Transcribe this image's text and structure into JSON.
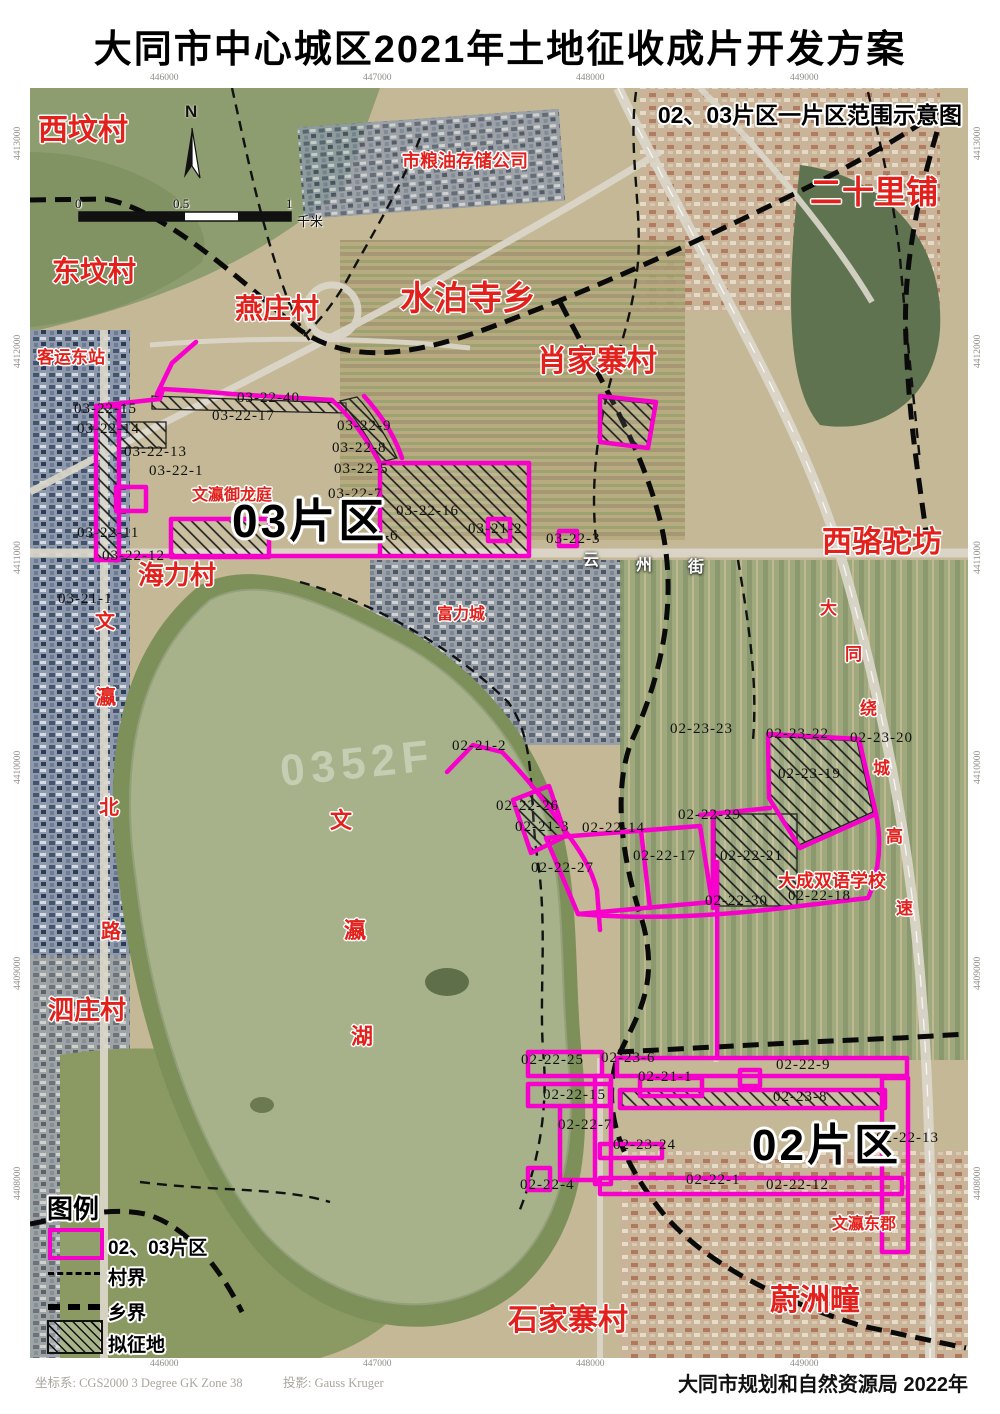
{
  "title": "大同市中心城区2021年土地征收成片开发方案",
  "inset_title": "02、03片区一片区范围示意图",
  "north_label": "N",
  "scale_bar": {
    "ticks": [
      "0",
      "0.5",
      "1"
    ],
    "unit": "千米"
  },
  "legend": {
    "title": "图例",
    "items": [
      {
        "symbol": "magenta-rect",
        "label": "02、03片区"
      },
      {
        "symbol": "thin-dashed-line",
        "label": "村界"
      },
      {
        "symbol": "thick-dashed-line",
        "label": "乡界"
      },
      {
        "symbol": "hatched-rect",
        "label": "拟征地"
      }
    ]
  },
  "footer": {
    "crs_label": "坐标系: CGS2000 3 Degree GK Zone 38",
    "projection_label": "投影: Gauss Kruger",
    "agency": "大同市规划和自然资源局 2022年"
  },
  "colors": {
    "parcel_boundary": "#f800cb",
    "place_label": "#e2211c",
    "district_label": "#000000",
    "road_label": "#ffffff",
    "hatch": "#1a1a1a"
  },
  "grid_coordinates": {
    "top": [
      "446000",
      "447000",
      "448000",
      "449000"
    ],
    "bottom": [
      "446000",
      "447000",
      "448000",
      "449000"
    ],
    "left": [
      "4413000",
      "4412000",
      "4411000",
      "4410000",
      "4409000",
      "4408000"
    ],
    "right": [
      "4413000",
      "4412000",
      "4411000",
      "4410000",
      "4409000",
      "4408000"
    ]
  },
  "map": {
    "area_labels": [
      {
        "t": "03片区",
        "x": 232,
        "y": 498,
        "fs": 46
      },
      {
        "t": "02片区",
        "x": 752,
        "y": 1124,
        "fs": 44
      }
    ],
    "place_labels": [
      {
        "t": "西坟村",
        "x": 38,
        "y": 116,
        "fs": 30
      },
      {
        "t": "东坟村",
        "x": 52,
        "y": 258,
        "fs": 28
      },
      {
        "t": "燕庄村",
        "x": 235,
        "y": 295,
        "fs": 28
      },
      {
        "t": "水泊寺乡",
        "x": 400,
        "y": 282,
        "fs": 34
      },
      {
        "t": "肖家寨村",
        "x": 537,
        "y": 347,
        "fs": 30
      },
      {
        "t": "市粮油存储公司",
        "x": 402,
        "y": 152,
        "fs": 18
      },
      {
        "t": "二十里铺",
        "x": 810,
        "y": 176,
        "fs": 32
      },
      {
        "t": "客运东站",
        "x": 37,
        "y": 349,
        "fs": 17
      },
      {
        "t": "西骆驼坊",
        "x": 822,
        "y": 528,
        "fs": 30
      },
      {
        "t": "海力村",
        "x": 138,
        "y": 562,
        "fs": 26
      },
      {
        "t": "文瀛御龙庭",
        "x": 192,
        "y": 488,
        "fs": 16
      },
      {
        "t": "富力城",
        "x": 437,
        "y": 607,
        "fs": 16
      },
      {
        "t": "大成双语学校",
        "x": 778,
        "y": 872,
        "fs": 18
      },
      {
        "t": "泗庄村",
        "x": 48,
        "y": 997,
        "fs": 26
      },
      {
        "t": "石家寨村",
        "x": 508,
        "y": 1306,
        "fs": 30
      },
      {
        "t": "蔚洲疃",
        "x": 770,
        "y": 1286,
        "fs": 30
      },
      {
        "t": "文瀛东郡",
        "x": 832,
        "y": 1217,
        "fs": 16
      },
      {
        "t": "文",
        "x": 95,
        "y": 612,
        "fs": 20
      },
      {
        "t": "瀛",
        "x": 96,
        "y": 688,
        "fs": 20
      },
      {
        "t": "北",
        "x": 99,
        "y": 798,
        "fs": 20
      },
      {
        "t": "路",
        "x": 101,
        "y": 922,
        "fs": 20
      },
      {
        "t": "文",
        "x": 330,
        "y": 810,
        "fs": 22
      },
      {
        "t": "瀛",
        "x": 344,
        "y": 920,
        "fs": 22
      },
      {
        "t": "湖",
        "x": 351,
        "y": 1026,
        "fs": 22
      },
      {
        "t": "大",
        "x": 820,
        "y": 600,
        "fs": 17
      },
      {
        "t": "同",
        "x": 845,
        "y": 646,
        "fs": 17
      },
      {
        "t": "绕",
        "x": 860,
        "y": 700,
        "fs": 17
      },
      {
        "t": "城",
        "x": 873,
        "y": 760,
        "fs": 17
      },
      {
        "t": "高",
        "x": 886,
        "y": 828,
        "fs": 17
      },
      {
        "t": "速",
        "x": 896,
        "y": 900,
        "fs": 17
      }
    ],
    "road_labels_white": [
      {
        "t": "云",
        "x": 583,
        "y": 553,
        "fs": 16
      },
      {
        "t": "州",
        "x": 636,
        "y": 558,
        "fs": 16
      },
      {
        "t": "街",
        "x": 688,
        "y": 560,
        "fs": 16
      }
    ],
    "parcel_labels": [
      {
        "t": "03-22-40",
        "x": 237,
        "y": 391
      },
      {
        "t": "03-22-17",
        "x": 212,
        "y": 409
      },
      {
        "t": "03-22-15",
        "x": 74,
        "y": 402
      },
      {
        "t": "03-22-14",
        "x": 77,
        "y": 422
      },
      {
        "t": "03-22-13",
        "x": 124,
        "y": 445
      },
      {
        "t": "03-22-1",
        "x": 149,
        "y": 464
      },
      {
        "t": "03-22-11",
        "x": 77,
        "y": 526
      },
      {
        "t": "03-22-12",
        "x": 102,
        "y": 549
      },
      {
        "t": "03-21-1",
        "x": 58,
        "y": 592
      },
      {
        "t": "03-22-9",
        "x": 337,
        "y": 419
      },
      {
        "t": "03-22-8",
        "x": 332,
        "y": 441
      },
      {
        "t": "03-22-5",
        "x": 334,
        "y": 462
      },
      {
        "t": "03-22-7",
        "x": 328,
        "y": 487
      },
      {
        "t": "03-22-16",
        "x": 396,
        "y": 504
      },
      {
        "t": "03-21-6",
        "x": 344,
        "y": 529
      },
      {
        "t": "03-21-2",
        "x": 468,
        "y": 522
      },
      {
        "t": "03-22-3",
        "x": 546,
        "y": 532
      },
      {
        "t": "02-23-23",
        "x": 670,
        "y": 722
      },
      {
        "t": "02-23-22",
        "x": 766,
        "y": 727
      },
      {
        "t": "02-23-20",
        "x": 850,
        "y": 731
      },
      {
        "t": "02-23-19",
        "x": 778,
        "y": 767
      },
      {
        "t": "02-22-29",
        "x": 678,
        "y": 808
      },
      {
        "t": "02-21-2",
        "x": 452,
        "y": 739
      },
      {
        "t": "02-22-26",
        "x": 496,
        "y": 799
      },
      {
        "t": "02-21-3",
        "x": 515,
        "y": 820
      },
      {
        "t": "02-22-14",
        "x": 582,
        "y": 821
      },
      {
        "t": "02-22-17",
        "x": 633,
        "y": 849
      },
      {
        "t": "02-22-21",
        "x": 720,
        "y": 849
      },
      {
        "t": "02-22-27",
        "x": 531,
        "y": 861
      },
      {
        "t": "02-22-30",
        "x": 705,
        "y": 894
      },
      {
        "t": "02-22-18",
        "x": 788,
        "y": 889
      },
      {
        "t": "02-22-25",
        "x": 521,
        "y": 1053
      },
      {
        "t": "02-23-6",
        "x": 601,
        "y": 1051
      },
      {
        "t": "02-21-1",
        "x": 638,
        "y": 1070
      },
      {
        "t": "02-22-9",
        "x": 776,
        "y": 1058
      },
      {
        "t": "02-22-15",
        "x": 543,
        "y": 1088
      },
      {
        "t": "02-23-8",
        "x": 773,
        "y": 1090
      },
      {
        "t": "02-22-7",
        "x": 558,
        "y": 1118
      },
      {
        "t": "02-23-24",
        "x": 613,
        "y": 1138
      },
      {
        "t": "02-22-13",
        "x": 876,
        "y": 1131
      },
      {
        "t": "02-22-4",
        "x": 520,
        "y": 1178
      },
      {
        "t": "02-22-1",
        "x": 686,
        "y": 1173
      },
      {
        "t": "02-22-12",
        "x": 766,
        "y": 1178
      }
    ],
    "watermarks": [
      {
        "t": "0352F",
        "x": 280,
        "y": 742
      }
    ]
  }
}
